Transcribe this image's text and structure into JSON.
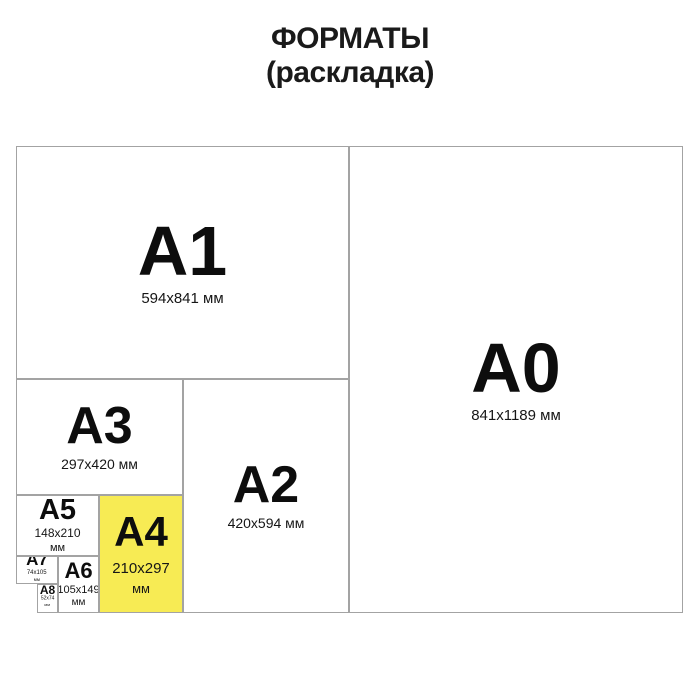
{
  "title": {
    "line1": "ФОРМАТЫ",
    "line2": "(раскладка)"
  },
  "colors": {
    "highlight": "#f7eb54",
    "border": "#a3a3a3",
    "text": "#111111",
    "background": "#ffffff"
  },
  "formats": {
    "a0": {
      "label": "A0",
      "size": "841x1189 мм"
    },
    "a1": {
      "label": "A1",
      "size": "594x841 мм"
    },
    "a2": {
      "label": "A2",
      "size": "420x594 мм"
    },
    "a3": {
      "label": "A3",
      "size": "297x420 мм"
    },
    "a4": {
      "label": "A4",
      "size": "210x297",
      "unit": "мм"
    },
    "a5": {
      "label": "A5",
      "size": "148x210",
      "unit": "мм"
    },
    "a6": {
      "label": "A6",
      "size": "105x149",
      "unit": "мм"
    },
    "a7": {
      "label": "A7",
      "size": "74x105",
      "unit": "мм"
    },
    "a8": {
      "label": "A8",
      "size": "52x74",
      "unit": "мм"
    }
  }
}
